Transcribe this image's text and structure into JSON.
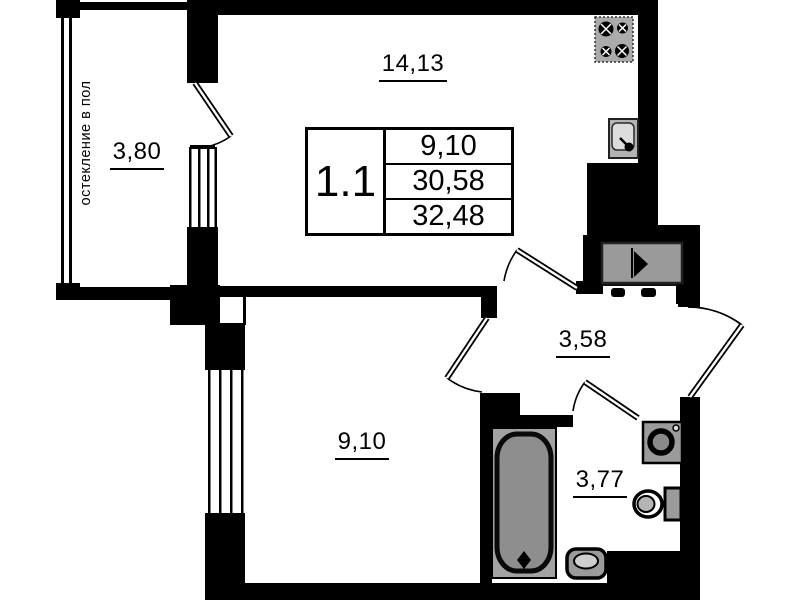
{
  "labels": {
    "main_room_area": "14,13",
    "balcony_area": "3,80",
    "bedroom_area": "9,10",
    "hallway_area": "3,58",
    "bathroom_area": "3,77",
    "balcony_note": "остекление в пол"
  },
  "info_table": {
    "unit_number": "1.1",
    "values": [
      "9,10",
      "30,58",
      "32,48"
    ]
  },
  "colors": {
    "wall": "#000000",
    "fixture_gray": "#9b9b9b",
    "background": "#ffffff"
  }
}
